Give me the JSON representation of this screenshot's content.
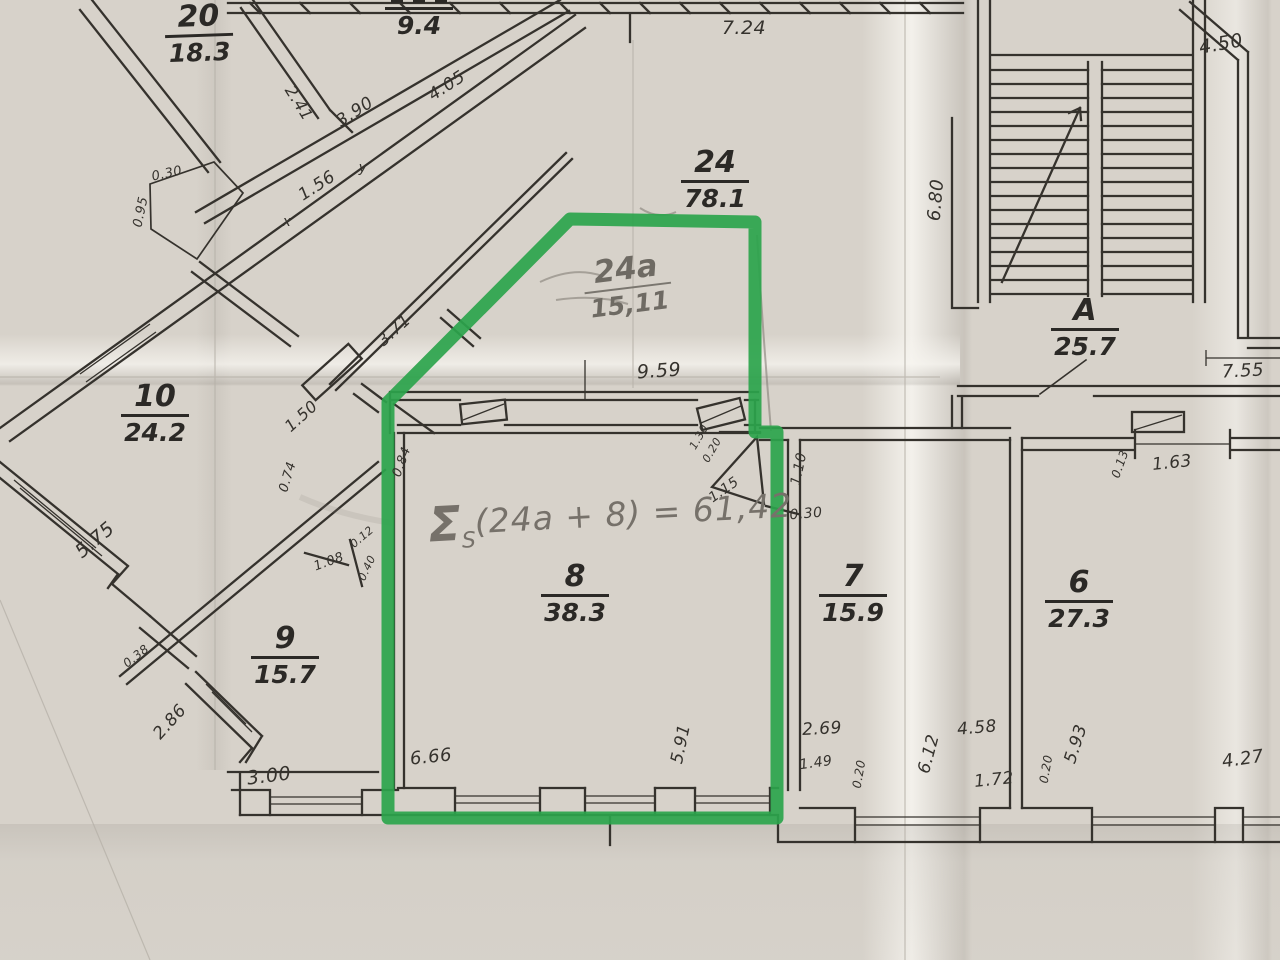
{
  "document": {
    "kind": "scanned hand-drawn floor plan photo",
    "paper_color": "#d7d2ca",
    "ink_color": "#35322d",
    "pencil_color": "#76716a"
  },
  "highlight": {
    "marked_rooms": "24a + 8",
    "color": "#2ba44c"
  },
  "rooms": {
    "r20": {
      "number": "20",
      "area": "18.3"
    },
    "r26": {
      "number": "",
      "area": "9.4"
    },
    "r24": {
      "number": "24",
      "area": "78.1"
    },
    "r24a": {
      "number": "24a",
      "area": "15,11"
    },
    "r10": {
      "number": "10",
      "area": "24.2"
    },
    "r9": {
      "number": "9",
      "area": "15.7"
    },
    "r8": {
      "number": "8",
      "area": "38.3"
    },
    "r7": {
      "number": "7",
      "area": "15.9"
    },
    "r6": {
      "number": "6",
      "area": "27.3"
    },
    "rA": {
      "number": "A",
      "area": "25.7"
    }
  },
  "formula": {
    "sigma": "Σ",
    "sub": "S",
    "body": "(24a + 8) = 61,42"
  },
  "dims": {
    "d724": "7.24",
    "d241": "2.41",
    "d390": "3.90",
    "d405": "4.05",
    "d030a": "0.30",
    "d095": "0.95",
    "d156": "1.56",
    "dxm": "x",
    "dym": "y",
    "d371": "3.71",
    "d150": "1.50",
    "d074": "0.74",
    "d575": "5.75",
    "d084": "0.84",
    "d012": "0.12",
    "d108": "1.08",
    "d040": "0.40",
    "d038": "0.38",
    "d286": "2.86",
    "d300": "3.00",
    "d666": "6.66",
    "d959": "9.59",
    "d591": "5.91",
    "d130": "1.30",
    "d020a": "0.20",
    "d115": "1.15",
    "d110": "1.10",
    "d030b": "0.30",
    "d269": "2.69",
    "d149": "1.49",
    "d020b": "0.20",
    "d612": "6.12",
    "d458": "4.58",
    "d172": "1.72",
    "d020c": "0.20",
    "d593": "5.93",
    "d427": "4.27",
    "d680": "6.80",
    "d450": "4.50",
    "d755": "7.55",
    "d013": "0.13",
    "d163": "1.63"
  }
}
